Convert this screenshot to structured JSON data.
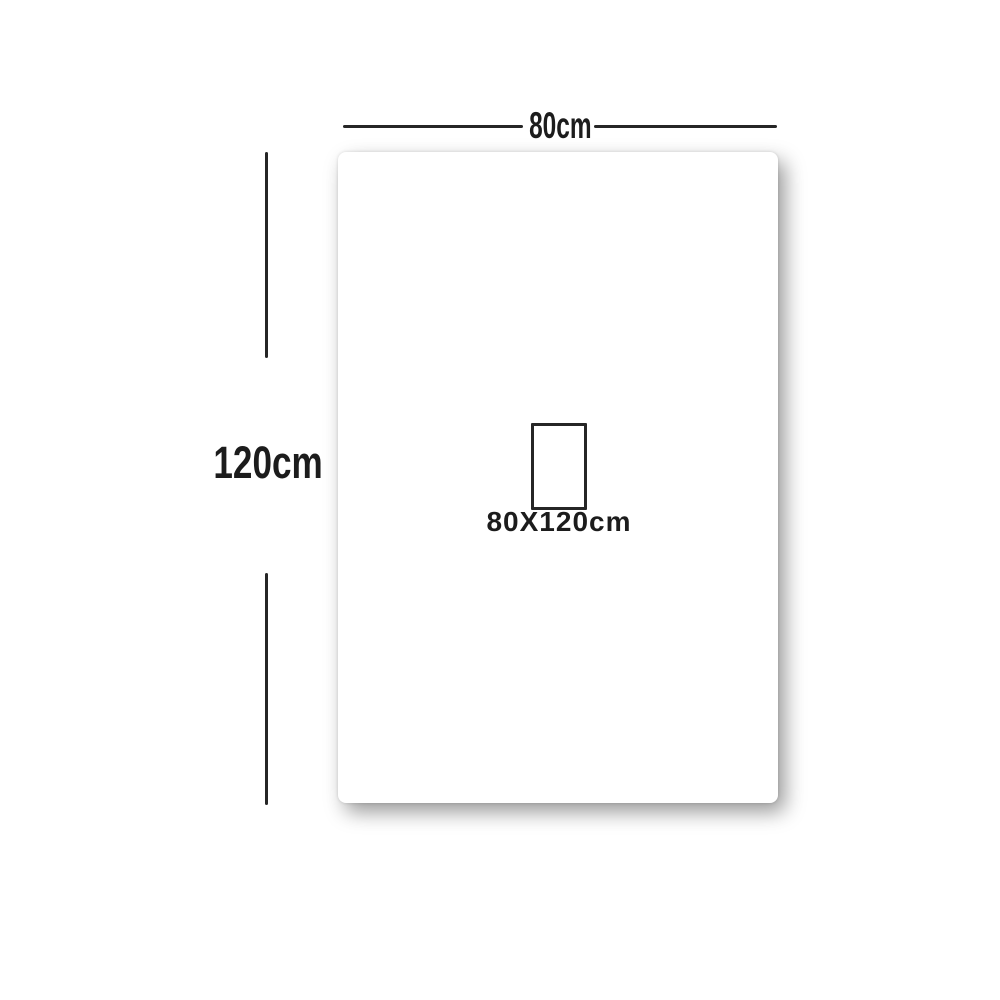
{
  "diagram": {
    "type": "product-dimension-diagram",
    "product": {
      "width_cm": 80,
      "height_cm": 120
    },
    "labels": {
      "width": "80cm",
      "height": "120cm",
      "size": "80X120cm"
    },
    "colors": {
      "background": "#ffffff",
      "card": "#ffffff",
      "line": "#262626",
      "text": "#1c1c1c"
    }
  }
}
